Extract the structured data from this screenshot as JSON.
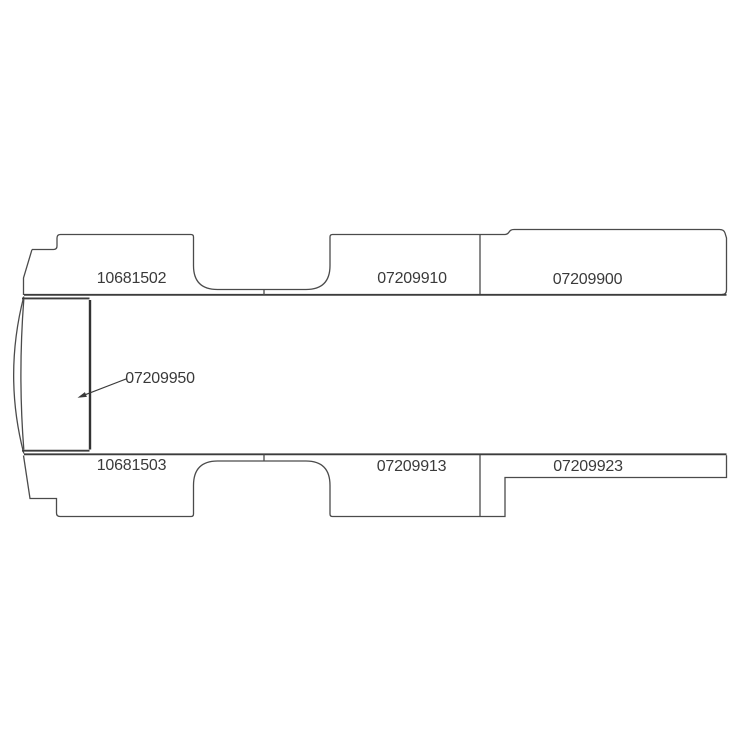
{
  "page": {
    "background_color": "#ffffff"
  },
  "diagram": {
    "name": "van-floor-panels-parts-diagram",
    "line_color": "#4b4b4b",
    "heavy_line_color": "#333333",
    "text_color": "#3a3a3a",
    "parts": [
      {
        "id": "10681502",
        "position": "top-left-sill-panel"
      },
      {
        "id": "07209910",
        "position": "top-middle-sill-panel"
      },
      {
        "id": "07209900",
        "position": "top-right-sill-panel"
      },
      {
        "id": "07209950",
        "position": "front-left-panel",
        "has_leader_arrow": true
      },
      {
        "id": "10681503",
        "position": "bottom-left-sill-panel"
      },
      {
        "id": "07209913",
        "position": "bottom-middle-sill-panel"
      },
      {
        "id": "07209923",
        "position": "bottom-right-sill-panel"
      }
    ]
  }
}
